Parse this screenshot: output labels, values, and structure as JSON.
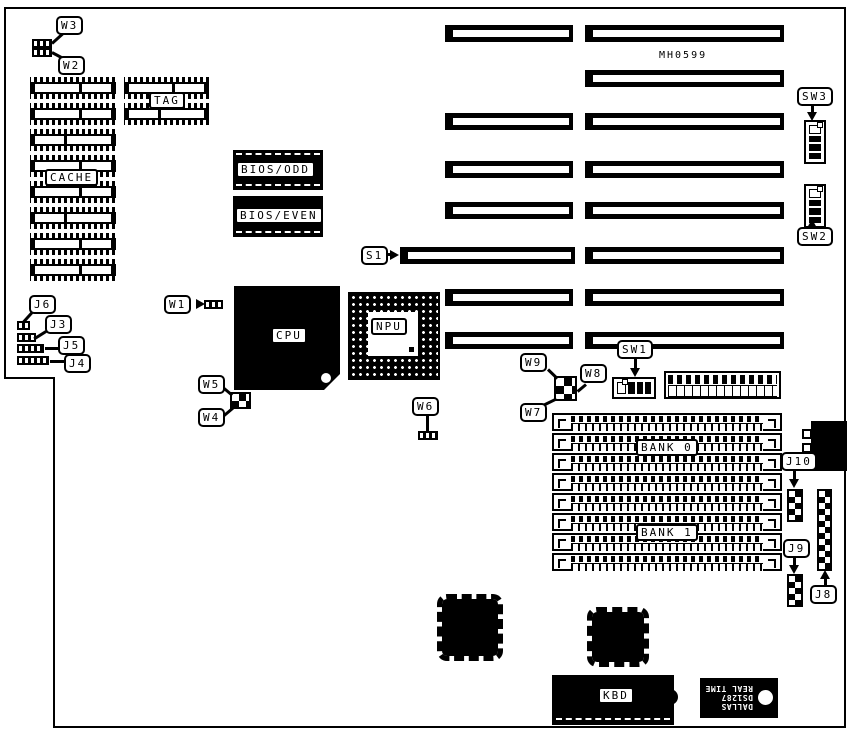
{
  "colors": {
    "ink": "#000000",
    "paper": "#ffffff"
  },
  "board": {
    "part_number": "MH0599",
    "chip_labels": {
      "cache": "CACHE",
      "tag": "TAG",
      "bios_odd": "BIOS/ODD",
      "bios_even": "BIOS/EVEN",
      "cpu": "CPU",
      "npu": "NPU",
      "bank0": "BANK 0",
      "bank1": "BANK 1",
      "kbd": "KBD"
    },
    "rtc": {
      "brand": "DALLAS",
      "part": "DS1287",
      "type": "REAL TIME"
    },
    "callouts": {
      "w1": "W1",
      "w2": "W2",
      "w3": "W3",
      "w4": "W4",
      "w5": "W5",
      "w6": "W6",
      "w7": "W7",
      "w8": "W8",
      "w9": "W9",
      "j3": "J3",
      "j4": "J4",
      "j5": "J5",
      "j6": "J6",
      "j8": "J8",
      "j9": "J9",
      "j10": "J10",
      "s1": "S1",
      "sw1": "SW1",
      "sw2": "SW2",
      "sw3": "SW3"
    }
  }
}
